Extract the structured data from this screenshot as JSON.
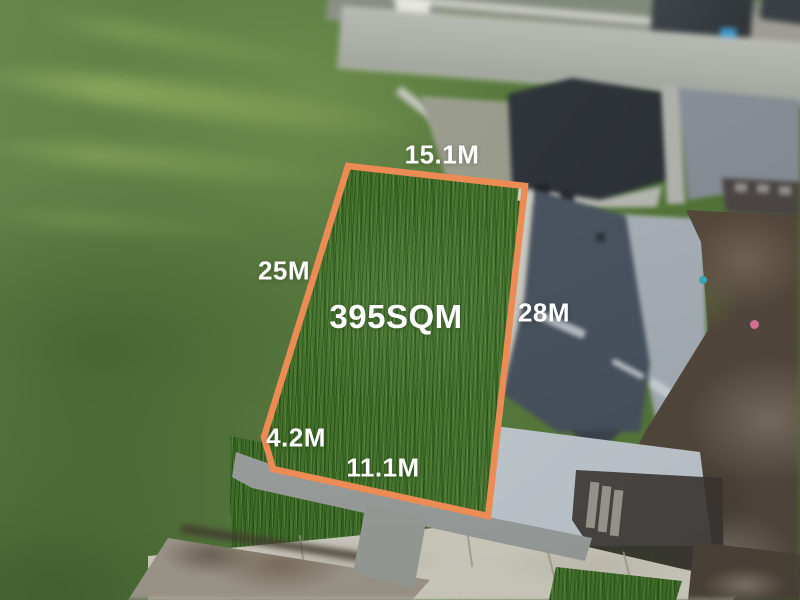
{
  "scene": {
    "type": "aerial-drone-photo",
    "subject": "vacant residential land lot outlined for sale"
  },
  "lot": {
    "area": "395SQM",
    "dim_top": "15.1M",
    "dim_left": "25M",
    "dim_right": "28M",
    "dim_bottom_left": "4.2M",
    "dim_bottom": "11.1M"
  },
  "colors": {
    "boundary": "#EC8C54",
    "label_text": "#FFFFFF"
  }
}
